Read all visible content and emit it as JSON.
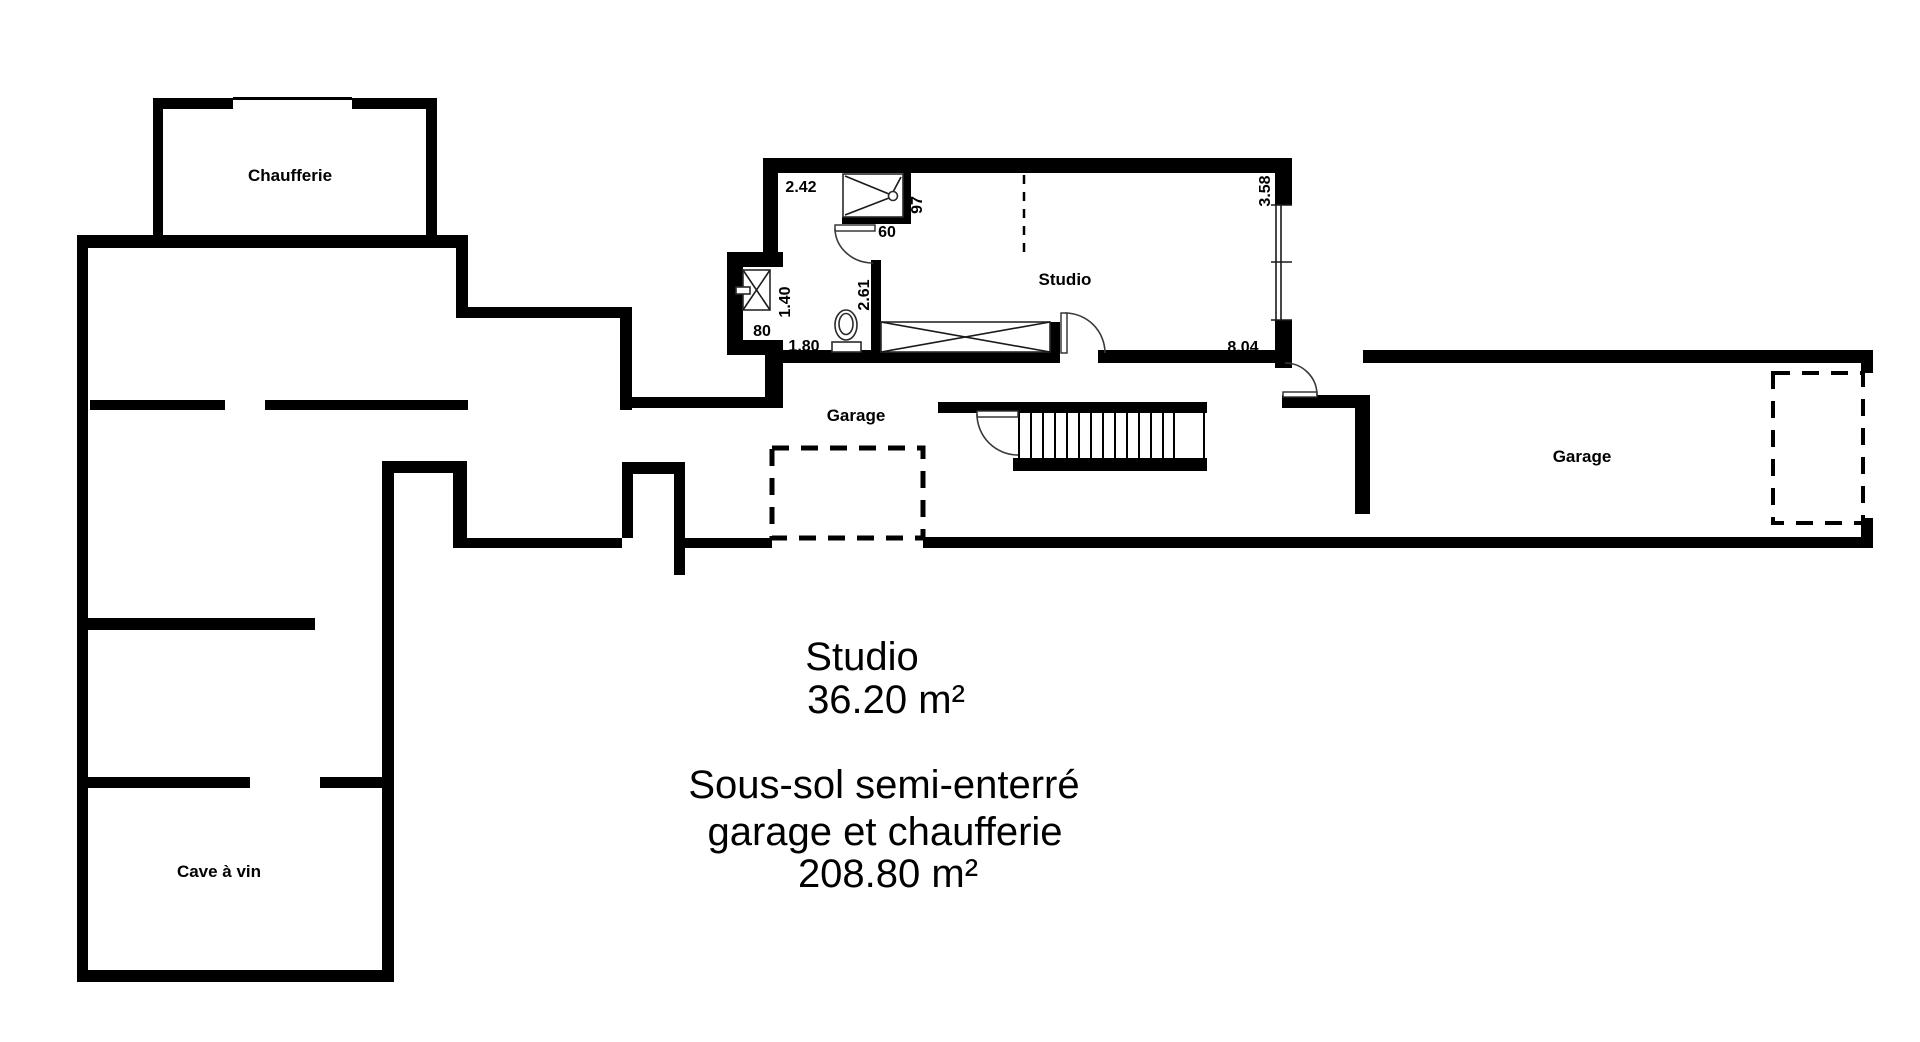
{
  "plan": {
    "rooms": {
      "chaufferie": "Chaufferie",
      "cave_a_vin": "Cave à vin",
      "studio": "Studio",
      "garage_middle": "Garage",
      "garage_right": "Garage"
    },
    "dims": {
      "w_242": "2.42",
      "w_97": "97",
      "w_60": "60",
      "w_261": "2.61",
      "w_140": "1.40",
      "w_80": "80",
      "w_180": "1,80",
      "w_804": "8.04",
      "w_358": "3.58"
    },
    "summary": {
      "studio_label": "Studio",
      "studio_area": "36.20 m²",
      "basement_line1": "Sous-sol semi-enterré",
      "basement_line2": "garage et chaufferie",
      "basement_area": "208.80 m²"
    },
    "colors": {
      "wall": "#000000",
      "background": "#ffffff",
      "text": "#000000"
    }
  }
}
